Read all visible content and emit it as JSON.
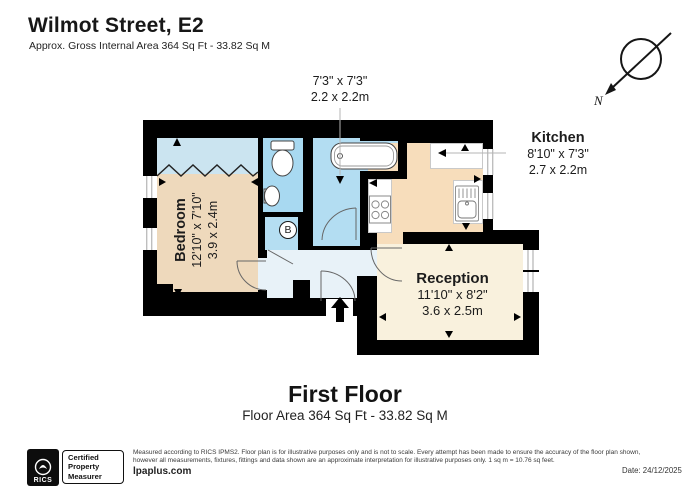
{
  "header": {
    "title": "Wilmot Street, E2",
    "subtitle": "Approx. Gross Internal Area 364 Sq Ft - 33.82 Sq M"
  },
  "compass": {
    "label": "N"
  },
  "plan": {
    "bathroom_dims": {
      "imperial": "7'3\" x 7'3\"",
      "metric": "2.2 x 2.2m"
    },
    "kitchen": {
      "name": "Kitchen",
      "imperial": "8'10\" x 7'3\"",
      "metric": "2.7 x 2.2m"
    },
    "bedroom": {
      "name": "Bedroom",
      "imperial": "12'10\" x 7'10\"",
      "metric": "3.9 x 2.4m"
    },
    "reception": {
      "name": "Reception",
      "imperial": "11'10\" x 8'2\"",
      "metric": "3.6 x 2.5m"
    },
    "boiler_label": "B"
  },
  "floor_heading": {
    "title": "First Floor",
    "area": "Floor Area 364 Sq Ft - 33.82 Sq M"
  },
  "footer": {
    "rics_label": "RICS",
    "certification": [
      "Certified",
      "Property",
      "Measurer"
    ],
    "disclaimer_line1": "Measured according to RICS IPMS2. Floor plan is for illustrative purposes only and is not to scale. Every attempt has been made to ensure the accuracy of the floor plan shown,",
    "disclaimer_line2": "however all measurements, fixtures, fittings and data shown are an approximate interpretation for illustrative purposes only. 1 sq m = 10.76 sq feet.",
    "website": "lpaplus.com",
    "date": "Date: 24/12/2025"
  },
  "colors": {
    "wall": "#000000",
    "bedroom_floor": "#eed9bc",
    "kitchen_floor": "#f7ddbb",
    "reception_floor": "#f9f1dd",
    "bathroom_floor": "#a8d9f1",
    "hall_floor": "#e8f2f8",
    "closet_floor": "#cbe4f0",
    "boiler_cupboard": "#b5def2"
  }
}
